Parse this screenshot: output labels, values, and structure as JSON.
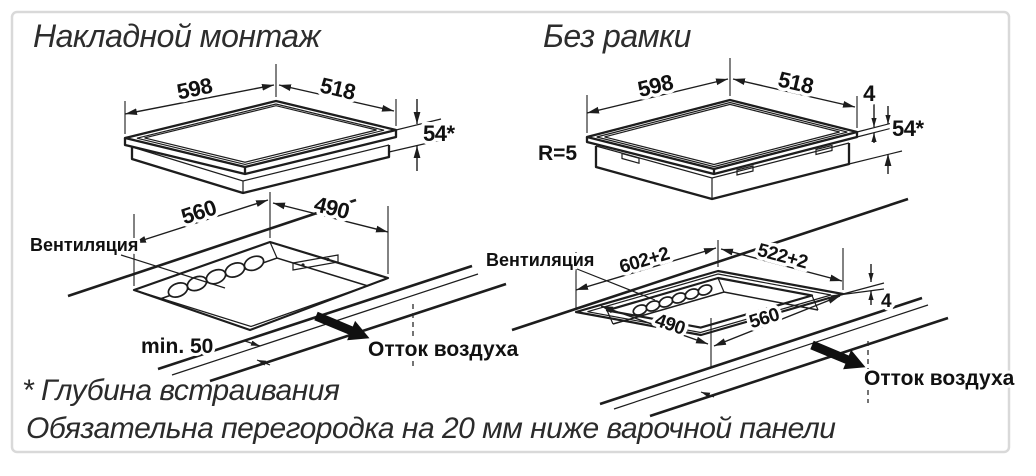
{
  "titles": {
    "left": "Накладной монтаж",
    "right": "Без рамки"
  },
  "left": {
    "hob": {
      "width": "598",
      "depth": "518",
      "height": "54*"
    },
    "cutout": {
      "width": "560",
      "depth": "490",
      "ventilation": "Вентиляция",
      "min_front": "min. 50",
      "outflow": "Отток воздуха"
    }
  },
  "right": {
    "hob": {
      "width": "598",
      "depth": "518",
      "height": "54*",
      "glass_thickness": "4",
      "corner_radius": "R=5"
    },
    "cutout": {
      "outer_width": "602+2",
      "outer_depth": "522+2",
      "inner_width": "560",
      "inner_depth": "490",
      "step_depth": "4",
      "ventilation": "Вентиляция",
      "outflow": "Отток воздуха"
    }
  },
  "footnotes": {
    "depth_note": "* Глубина встраивания",
    "partition_note": "Обязательна перегородка на 20 мм ниже варочной панели"
  },
  "colors": {
    "line": "#1d1d1d",
    "border": "#d9d9d9",
    "background": "#ffffff"
  }
}
